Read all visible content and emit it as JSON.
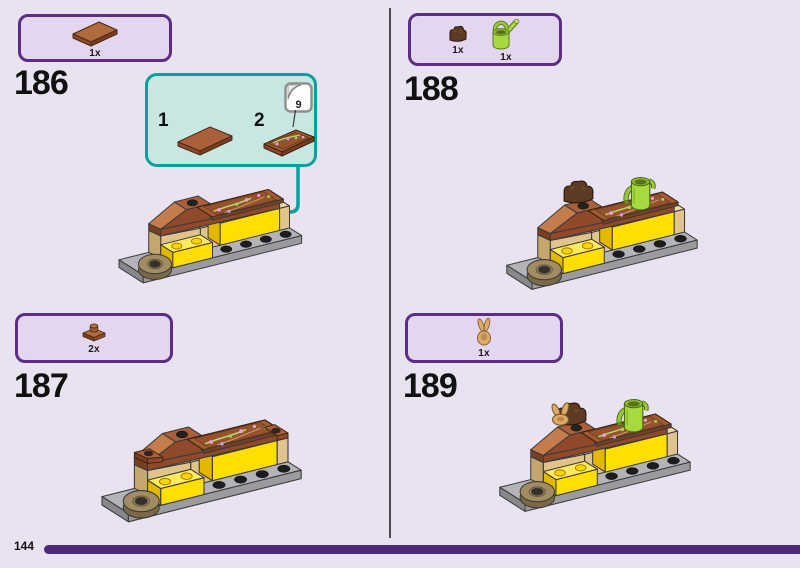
{
  "page": {
    "type": "lego-instruction-page",
    "background_color": "#e9e2f1",
    "accent_purple": "#5b2d87",
    "teal_accent": "#0aa09e",
    "footer_bar_color": "#4b2878"
  },
  "steps": [
    {
      "number": "186",
      "parts": [
        {
          "count": "1x",
          "icon": "reddish-brown-tile-2x4-icon"
        }
      ]
    },
    {
      "number": "187",
      "parts": [
        {
          "count": "2x",
          "icon": "reddish-brown-plate-1x1-icon"
        }
      ]
    },
    {
      "number": "188",
      "parts": [
        {
          "count": "1x",
          "icon": "dark-brown-roots-piece-icon"
        },
        {
          "count": "1x",
          "icon": "lime-watering-can-icon"
        }
      ]
    },
    {
      "number": "189",
      "parts": [
        {
          "count": "1x",
          "icon": "tan-rabbit-piece-icon"
        }
      ]
    }
  ],
  "callout": {
    "item1_label": "1",
    "item2_label": "2",
    "sticker_sheet_number": "9"
  },
  "footer": {
    "page_number": "144"
  }
}
